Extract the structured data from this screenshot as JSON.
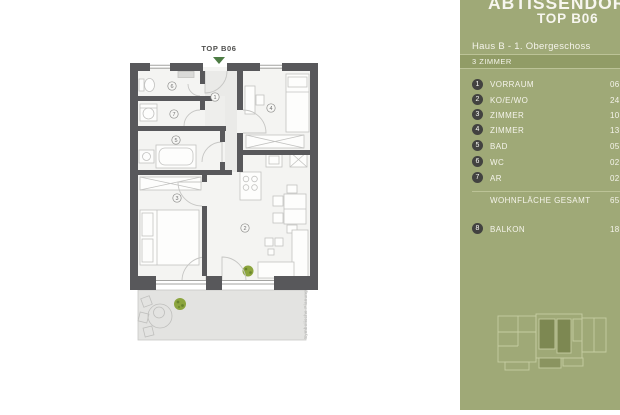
{
  "plan": {
    "top_label": "TOP B06",
    "watermark": "Symbolische Planung"
  },
  "panel": {
    "project_title": "ABTISSENDORF",
    "unit_title": "TOP B06",
    "subtitle": "Haus B - 1. Obergeschoss",
    "category": "3 ZIMMER",
    "rooms": [
      {
        "num": "1",
        "label": "VORRAUM",
        "value": "06,3"
      },
      {
        "num": "2",
        "label": "KO/E/WO",
        "value": "24,1"
      },
      {
        "num": "3",
        "label": "ZIMMER",
        "value": "10,9"
      },
      {
        "num": "4",
        "label": "ZIMMER",
        "value": "13,8"
      },
      {
        "num": "5",
        "label": "BAD",
        "value": "05,1"
      },
      {
        "num": "6",
        "label": "WC",
        "value": "02,2"
      },
      {
        "num": "7",
        "label": "AR",
        "value": "02,5"
      }
    ],
    "total": {
      "label": "WOHNFLÄCHE GESAMT",
      "value": "65,1"
    },
    "balcony": {
      "num": "8",
      "label": "BALKON",
      "value": "18,2"
    }
  },
  "colors": {
    "panel_green": "#9fa977",
    "band_green": "#919c66",
    "wall_gray": "#58585b",
    "plant_green": "#8ca53e",
    "arrow_green": "#4d7c44"
  }
}
